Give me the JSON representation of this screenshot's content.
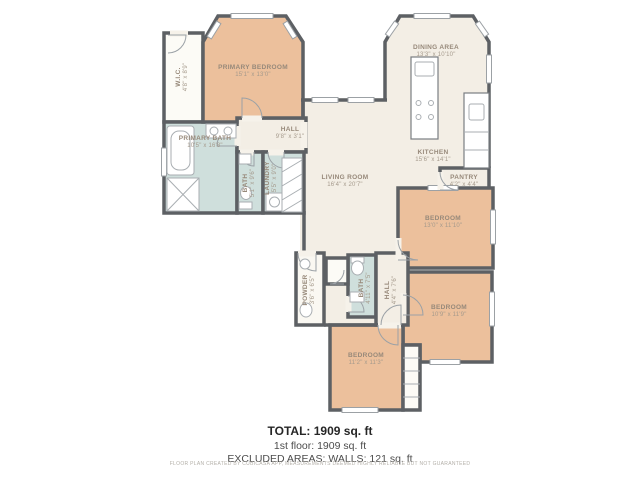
{
  "plan": {
    "rooms": {
      "primary_bedroom": {
        "name": "PRIMARY BEDROOM",
        "dims": "15'1\" x 13'0\""
      },
      "wic": {
        "name": "W.I.C.",
        "dims": "4'8\" x 8'9\""
      },
      "primary_bath": {
        "name": "PRIMARY BATH",
        "dims": "10'5\" x 16'8\""
      },
      "hall_top": {
        "name": "HALL",
        "dims": "9'8\" x 3'1\""
      },
      "bath_left": {
        "name": "BATH",
        "dims": "5'1\" x 9'6\""
      },
      "laundry": {
        "name": "LAUNDRY",
        "dims": "5'5\" x 9'0\""
      },
      "dining": {
        "name": "DINING AREA",
        "dims": "13'3\" x 10'10\""
      },
      "kitchen": {
        "name": "KITCHEN",
        "dims": "15'6\" x 14'1\""
      },
      "pantry": {
        "name": "PANTRY",
        "dims": "4'2\" x 4'4\""
      },
      "living": {
        "name": "LIVING ROOM",
        "dims": "16'4\" x 20'7\""
      },
      "bedroom_right": {
        "name": "BEDROOM",
        "dims": "13'0\" x 11'10\""
      },
      "bedroom_bottom_right": {
        "name": "BEDROOM",
        "dims": "10'9\" x 11'9\""
      },
      "bedroom_bottom": {
        "name": "BEDROOM",
        "dims": "11'2\" x 11'3\""
      },
      "powder": {
        "name": "POWDER",
        "dims": "3'6\" x 6'5\""
      },
      "bath_bottom": {
        "name": "BATH",
        "dims": "4'11\" x 7'5\""
      },
      "hall_bottom": {
        "name": "HALL",
        "dims": "4'4\" x 7'6\""
      }
    },
    "summary": {
      "total": "TOTAL: 1909 sq. ft",
      "floor1": "1st floor: 1909 sq. ft",
      "excluded": "EXCLUDED AREAS: WALLS: 121 sq. ft"
    },
    "disclaimer": "FLOOR PLAN CREATED BY CUBICASA APP, MEASUREMENTS DEEMED HIGHLY RELIABLE BUT NOT GUARANTEED",
    "colors": {
      "wall": "#5d6064",
      "bedroom": "#ecc09c",
      "bath": "#cfdfdc",
      "common": "#f3eee5"
    }
  }
}
